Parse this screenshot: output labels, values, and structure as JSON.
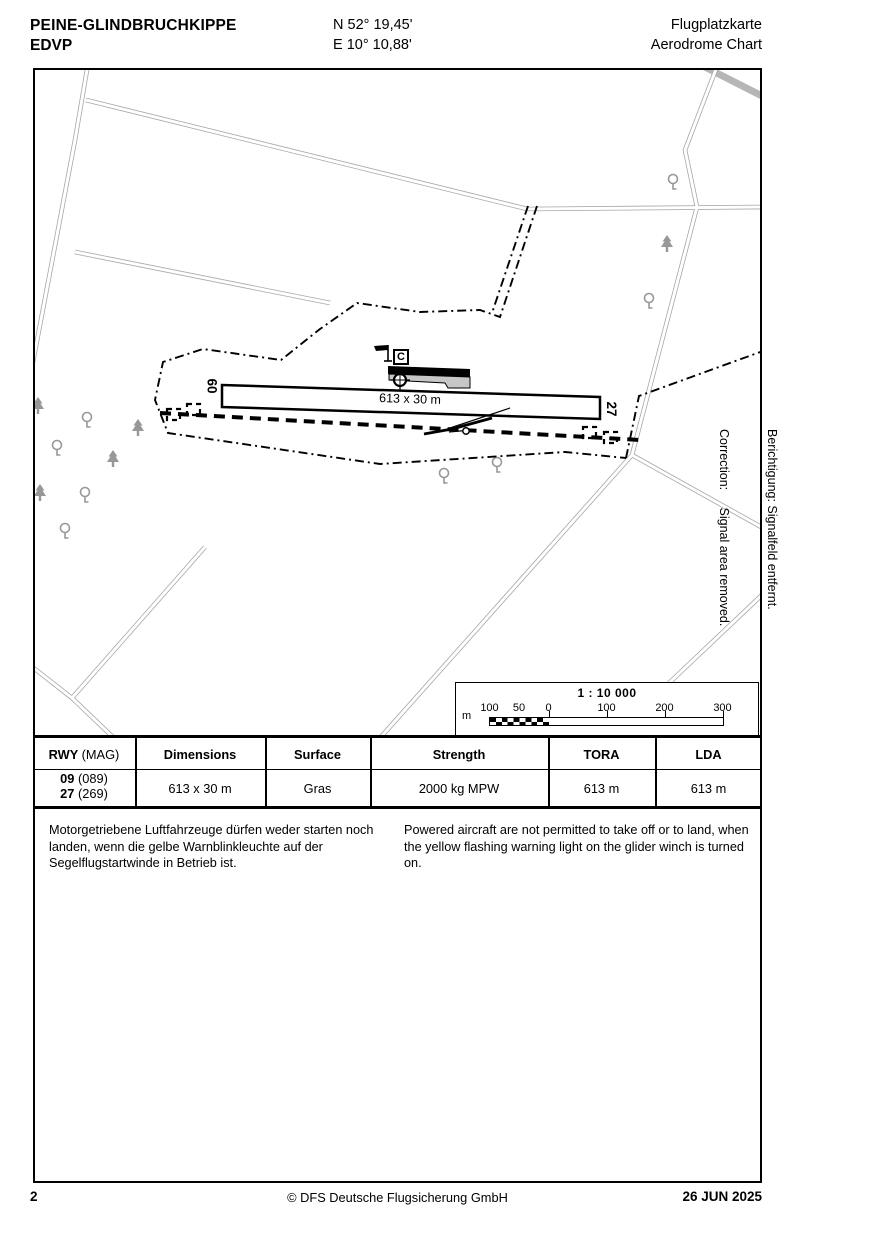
{
  "header": {
    "aerodrome_name": "PEINE-GLINDBRUCHKIPPE",
    "icao_code": "EDVP",
    "latitude": "N 52° 19,45'",
    "longitude": "E 10° 10,88'",
    "chart_title_de": "Flugplatzkarte",
    "chart_title_en": "Aerodrome Chart"
  },
  "map": {
    "runway_dimensions_label": "613 x 30 m",
    "rwy_designator_west": "09",
    "rwy_designator_east": "27",
    "reporting_point": "C",
    "scale": {
      "ratio": "1 : 10 000",
      "unit": "m",
      "ticks": [
        "100",
        "50",
        "0",
        "100",
        "200",
        "300"
      ]
    }
  },
  "margin_note": {
    "de": "Berichtigung: Signalfeld entfernt.",
    "en": "Correction:     Signal area removed."
  },
  "runway_table": {
    "headers": {
      "rwy": "RWY",
      "mag": "(MAG)",
      "dimensions": "Dimensions",
      "surface": "Surface",
      "strength": "Strength",
      "tora": "TORA",
      "lda": "LDA"
    },
    "row": {
      "rwy_1": "09",
      "mag_1": "(089)",
      "rwy_2": "27",
      "mag_2": "(269)",
      "dimensions": "613 x 30 m",
      "surface": "Gras",
      "strength": "2000 kg MPW",
      "tora": "613 m",
      "lda": "613 m"
    }
  },
  "notes": {
    "de": "Motorgetriebene Luftfahrzeuge dürfen weder starten noch landen, wenn die gelbe Warnblinkleuchte auf der Segelflugstartwinde in Betrieb ist.",
    "en": "Powered aircraft are not permitted to take off or to land, when the yellow flashing warning light on the glider winch is turned on."
  },
  "footer": {
    "page_number": "2",
    "copyright": "© DFS Deutsche Flugsicherung GmbH",
    "date": "26 JUN 2025"
  }
}
